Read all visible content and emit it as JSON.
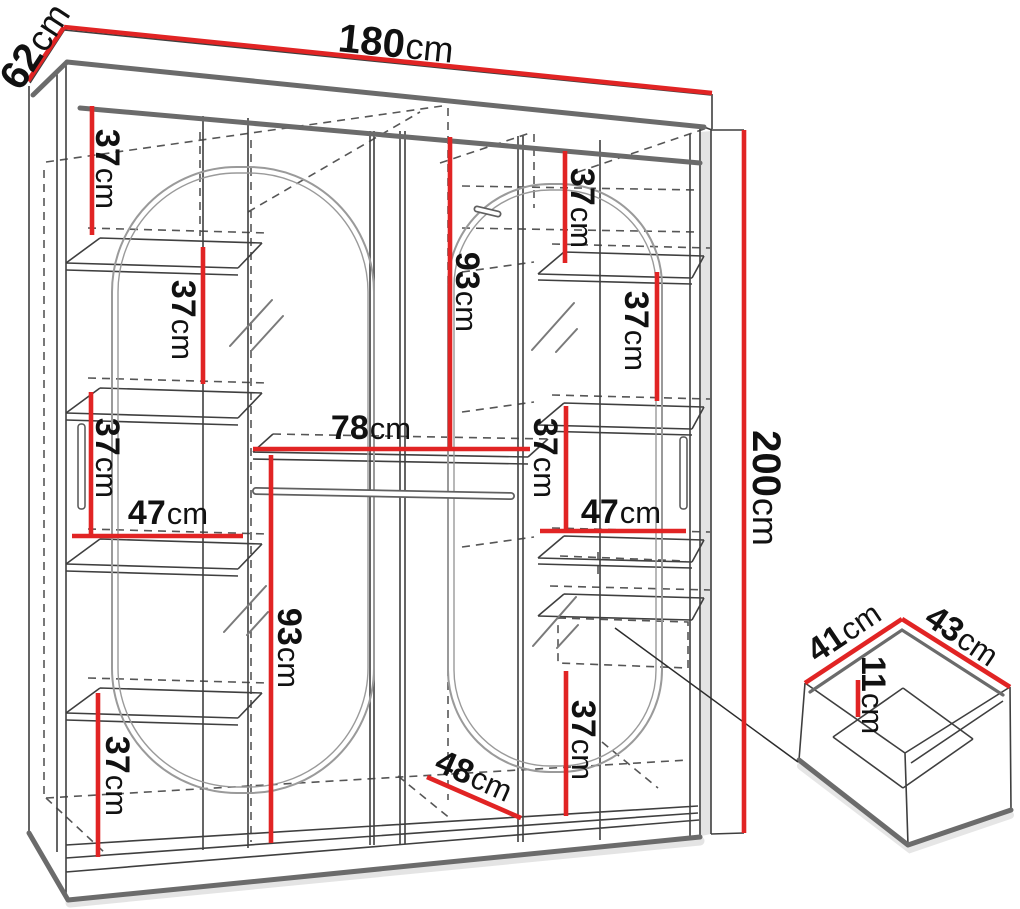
{
  "colors": {
    "dimension_red": "#e12424",
    "edge_gray": "#6b6b6b",
    "line_dark": "#3f3f3f",
    "text_color": "#111111"
  },
  "labels": [
    {
      "id": "depth",
      "value": "62",
      "unit": "cm"
    },
    {
      "id": "width",
      "value": "180",
      "unit": "cm"
    },
    {
      "id": "height",
      "value": "200",
      "unit": "cm"
    },
    {
      "id": "left-top-shelf-gap",
      "value": "37",
      "unit": "cm"
    },
    {
      "id": "left-second-shelf-gap",
      "value": "37",
      "unit": "cm"
    },
    {
      "id": "left-third-shelf-gap",
      "value": "37",
      "unit": "cm"
    },
    {
      "id": "left-shelf-width",
      "value": "47",
      "unit": "cm"
    },
    {
      "id": "left-hanging-height",
      "value": "93",
      "unit": "cm"
    },
    {
      "id": "left-bottom-gap",
      "value": "37",
      "unit": "cm"
    },
    {
      "id": "center-shelf-width",
      "value": "78",
      "unit": "cm"
    },
    {
      "id": "right-top-gap",
      "value": "37",
      "unit": "cm"
    },
    {
      "id": "right-hanging-height",
      "value": "93",
      "unit": "cm"
    },
    {
      "id": "right-upper-shelf-gap",
      "value": "37",
      "unit": "cm"
    },
    {
      "id": "right-mid-shelf-gap",
      "value": "37",
      "unit": "cm"
    },
    {
      "id": "right-shelf-width",
      "value": "47",
      "unit": "cm"
    },
    {
      "id": "right-bottom-gap",
      "value": "37",
      "unit": "cm"
    },
    {
      "id": "bottom-depth",
      "value": "48",
      "unit": "cm"
    },
    {
      "id": "drawer-depth",
      "value": "41",
      "unit": "cm"
    },
    {
      "id": "drawer-width",
      "value": "43",
      "unit": "cm"
    },
    {
      "id": "drawer-height",
      "value": "11",
      "unit": "cm"
    }
  ]
}
